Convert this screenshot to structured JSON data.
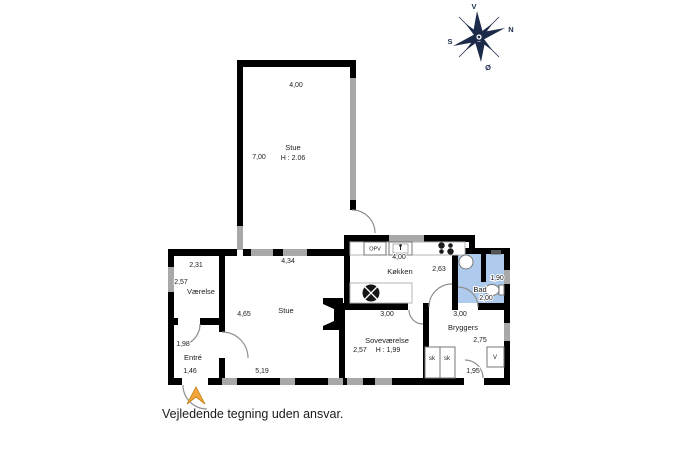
{
  "disclaimer": "Vejledende tegning uden ansvar.",
  "compass": {
    "top": "V",
    "upper_right": "N",
    "lower_left": "S",
    "bottom": "Ø"
  },
  "colors": {
    "wall": "#000000",
    "window": "#a8a8a8",
    "bathroom_fill": "#aecbee",
    "entry_arrow": "#f3a73b",
    "compass": "#1d2b4a"
  },
  "rooms": {
    "stue_top": {
      "name": "Stue",
      "ceiling_height": "H : 2.06",
      "dim_width": "4,00",
      "dim_depth": "7,00"
    },
    "stue": {
      "name": "Stue",
      "dim_top": "4,34",
      "dim_left": "4,65",
      "dim_bottom": "5,19"
    },
    "vaerelse": {
      "name": "Værelse",
      "dim_top": "2,31",
      "dim_left": "2,57"
    },
    "entre": {
      "name": "Entré",
      "dim_left": "1,98",
      "dim_bottom": "1,46"
    },
    "koekken": {
      "name": "Køkken",
      "dim_top": "4,00",
      "dim_right": "2,63",
      "dishwasher_label": "OPV"
    },
    "sovevaerelse": {
      "name": "Soveværelse",
      "ceiling_height": "H : 1,99",
      "dim_top": "3,00",
      "dim_left": "2,57"
    },
    "bad": {
      "name": "Bad",
      "dim_right": "1,90",
      "dim_bottom": "2,00"
    },
    "bryggers": {
      "name": "Bryggers",
      "dim_top": "3,00",
      "dim_right": "2,75",
      "dim_door": "1,95",
      "closet_a": "sk",
      "closet_b": "sk",
      "washer_label": "V"
    }
  }
}
